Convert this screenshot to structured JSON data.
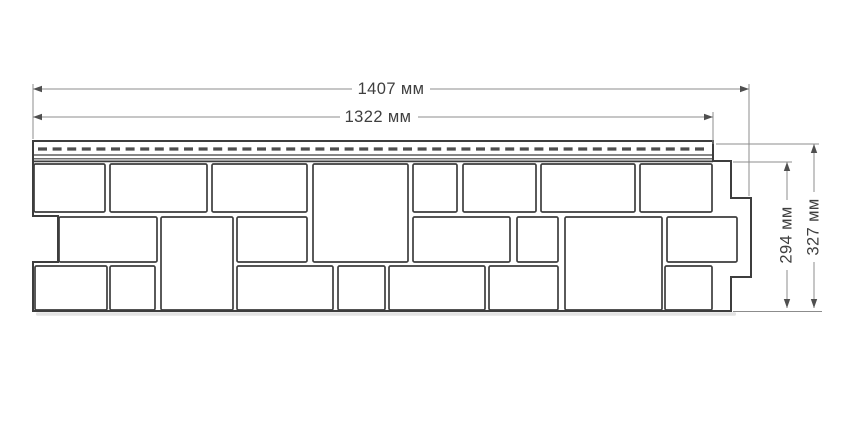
{
  "diagram": {
    "title": "facade panel dimensional drawing",
    "background": "#ffffff",
    "line_color": "#3d3d3d",
    "dim_line_color": "#8c8c8c",
    "arrow_color": "#4f4f4f",
    "text_color": "#3f3f3f",
    "slot_color": "#4d4d4d",
    "shadow_color": "#cccccc",
    "font_size": 16.5
  },
  "dimensions": {
    "outer_width": {
      "label": "1407 мм",
      "value_mm": 1407
    },
    "panel_width": {
      "label": "1322 мм",
      "value_mm": 1322
    },
    "panel_height": {
      "label": "294 мм",
      "value_mm": 294
    },
    "outer_height": {
      "label": "327 мм",
      "value_mm": 327
    }
  },
  "geometry": {
    "canvas": {
      "w": 850,
      "h": 425
    },
    "outline": [
      [
        33,
        141
      ],
      [
        713,
        141
      ],
      [
        713,
        161
      ],
      [
        731,
        161
      ],
      [
        731,
        198
      ],
      [
        751,
        198
      ],
      [
        751,
        277
      ],
      [
        731,
        277
      ],
      [
        731,
        311
      ],
      [
        33,
        311
      ],
      [
        33,
        262
      ],
      [
        58,
        262
      ],
      [
        58,
        216
      ],
      [
        33,
        216
      ]
    ],
    "strip_lines": [
      {
        "x1": 33,
        "x2": 713,
        "y": 155,
        "w": 1.2
      },
      {
        "x1": 33,
        "x2": 713,
        "y": 158.8,
        "w": 1.2
      },
      {
        "x1": 33,
        "x2": 713,
        "y": 161.4,
        "w": 1.8
      }
    ],
    "nail_slots": {
      "x1": 38,
      "x2": 706,
      "y": 149,
      "thickness": 3.2,
      "dash": 9,
      "gap": 5.6
    },
    "blocks": [
      [
        34,
        164,
        71,
        48
      ],
      [
        110,
        164,
        97,
        48
      ],
      [
        212,
        164,
        95,
        48
      ],
      [
        313,
        164,
        95,
        98
      ],
      [
        413,
        164,
        44,
        48
      ],
      [
        463,
        164,
        73,
        48
      ],
      [
        541,
        164,
        94,
        48
      ],
      [
        640,
        164,
        72,
        48
      ],
      [
        59,
        217,
        98,
        45
      ],
      [
        161,
        217,
        72,
        93
      ],
      [
        237,
        217,
        70,
        45
      ],
      [
        413,
        217,
        97,
        45
      ],
      [
        517,
        217,
        41,
        45
      ],
      [
        565,
        217,
        97,
        93
      ],
      [
        667,
        217,
        70,
        45
      ],
      [
        35,
        266,
        72,
        44
      ],
      [
        110,
        266,
        45,
        44
      ],
      [
        237,
        266,
        96,
        44
      ],
      [
        338,
        266,
        47,
        44
      ],
      [
        389,
        266,
        96,
        44
      ],
      [
        489,
        266,
        69,
        44
      ],
      [
        665,
        266,
        47,
        44
      ]
    ],
    "shadows": [
      {
        "x": 36,
        "y": 312.3,
        "w": 700,
        "h": 3.4
      }
    ],
    "h_dims": [
      {
        "key": "outer_width",
        "name": "dimension-outer-width",
        "y": 89,
        "x1": 33,
        "x2": 749,
        "gap": [
          352,
          430
        ],
        "label_x": 391,
        "ext": [
          {
            "x": 33,
            "y1": 84,
            "y2": 139
          },
          {
            "x": 749,
            "y1": 84,
            "y2": 196
          }
        ]
      },
      {
        "key": "panel_width",
        "name": "dimension-panel-width",
        "y": 117,
        "x1": 33,
        "x2": 713,
        "gap": [
          340,
          418
        ],
        "label_x": 378,
        "ext": [
          {
            "x": 713,
            "y1": 112,
            "y2": 144
          }
        ]
      }
    ],
    "v_dims": [
      {
        "key": "panel_height",
        "name": "dimension-panel-height",
        "x": 787,
        "y1": 162,
        "y2": 308,
        "gap": [
          200,
          270
        ],
        "label_y": 235,
        "leaders": [
          {
            "y": 162,
            "x1": 733,
            "x2": 792
          }
        ]
      },
      {
        "key": "outer_height",
        "name": "dimension-outer-height",
        "x": 814,
        "y1": 144,
        "y2": 308,
        "gap": [
          192,
          262
        ],
        "label_y": 227,
        "leaders": [
          {
            "y": 144,
            "x1": 716,
            "x2": 819
          },
          {
            "y": 311.5,
            "x1": 733,
            "x2": 822
          }
        ]
      }
    ],
    "arrow": {
      "len": 9,
      "half": 3.2
    }
  }
}
